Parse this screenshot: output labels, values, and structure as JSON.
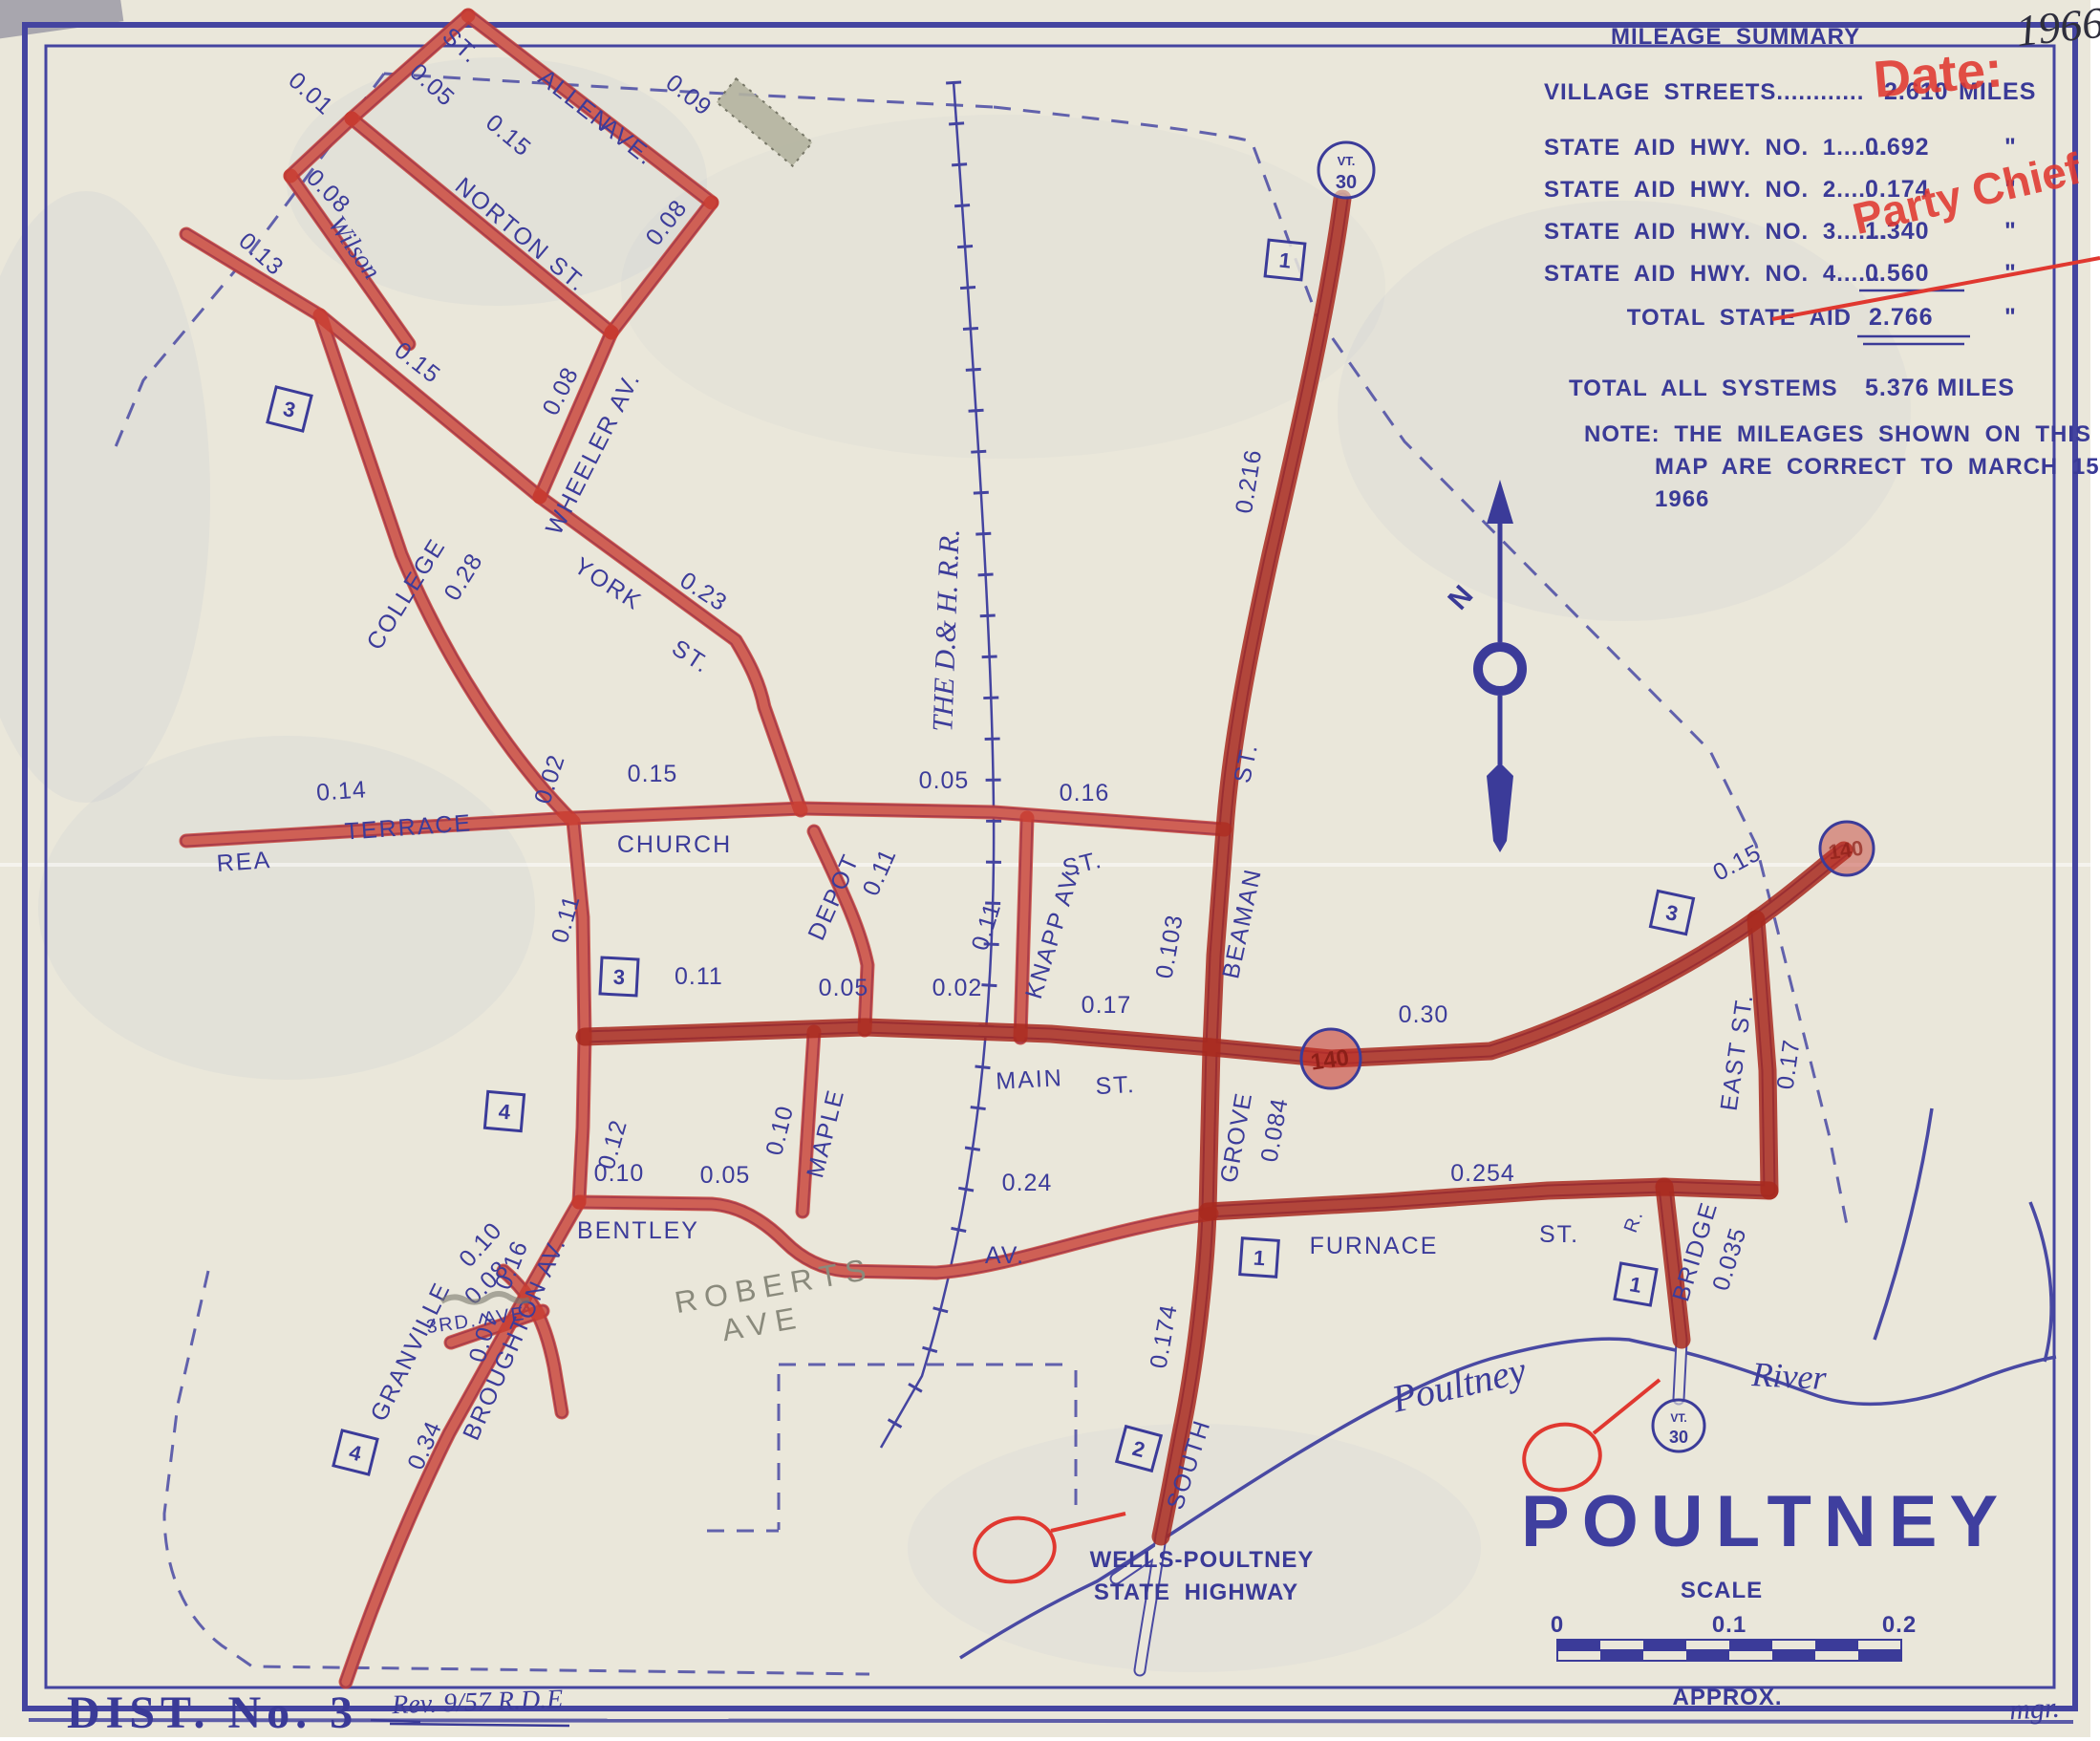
{
  "mileage_summary": {
    "title": "MILEAGE SUMMARY",
    "year_note": "1966",
    "rows": {
      "village": {
        "label": "VILLAGE STREETS",
        "dots": "............",
        "value": "2.610",
        "unit": "MILES"
      },
      "sa1": {
        "label": "STATE AID HWY. NO. 1",
        "dots": ".......",
        "value": "0.692",
        "unit": "\""
      },
      "sa2": {
        "label": "STATE AID HWY. NO. 2",
        "dots": ".....",
        "value": "0.174",
        "unit": "\""
      },
      "sa3": {
        "label": "STATE AID HWY. NO. 3",
        "dots": ".......",
        "value": "1.340",
        "unit": "\""
      },
      "sa4": {
        "label": "STATE AID HWY. NO. 4",
        "dots": "......",
        "value": "0.560",
        "unit": "\""
      },
      "total_state_aid": {
        "label": "TOTAL STATE AID",
        "value": "2.766",
        "unit": "\""
      },
      "total_all": {
        "label": "TOTAL ALL SYSTEMS",
        "value": "5.376 MILES"
      }
    },
    "note": {
      "l1": "NOTE: THE MILEAGES SHOWN ON THIS",
      "l2": "MAP ARE CORRECT TO MARCH 15,",
      "l3": "1966"
    }
  },
  "stamps": {
    "date": "Date:",
    "party_chief": "Party Chief"
  },
  "streets": {
    "allen": "ALLEN",
    "ave": "AVE.",
    "st": "ST.",
    "norton": "NORTON ST.",
    "wilson": "Wilson",
    "wheeler": "WHEELER AV.",
    "york": "YORK",
    "college": "COLLEGE",
    "rea": "REA",
    "terrace": "TERRACE",
    "church": "CHURCH",
    "depot": "DEPOT",
    "knapp": "KNAPP AV.",
    "main": "MAIN",
    "beaman": "BEAMAN",
    "grove": "GROVE",
    "south": "SOUTH",
    "furnace": "FURNACE",
    "east": "EAST ST.",
    "bridge": "BRIDGE",
    "r_abbr": "R.",
    "bentley": "BENTLEY",
    "av": "AV.",
    "maple": "MAPLE",
    "granville": "GRANVILLE",
    "broughton": "BROUGHTON AV.",
    "third": "3RD. AVE",
    "roberts_l1": "ROBERTS",
    "roberts_l2": "AVE",
    "railroad": "THE D.& H. R.R.",
    "river_l1": "Poultney",
    "river_l2": "River",
    "wells_l1": "WELLS-POULTNEY",
    "wells_l2": "STATE HIGHWAY"
  },
  "miles": {
    "m001": "0.01",
    "m002": "0.02",
    "m005": "0.05",
    "m007": "0.07",
    "m008": "0.08",
    "m009": "0.09",
    "m010": "0.10",
    "m011": "0.11",
    "m012": "0.12",
    "m013": "0.13",
    "m014": "0.14",
    "m015": "0.15",
    "m016": "0.16",
    "m017": "0.17",
    "m023": "0.23",
    "m024": "0.24",
    "m028": "0.28",
    "m030": "0.30",
    "m034": "0.34",
    "m035": "0.035",
    "m084": "0.084",
    "m103": "0.103",
    "m174": "0.174",
    "m216": "0.216",
    "m254": "0.254"
  },
  "markers": {
    "n1": "1",
    "n2": "2",
    "n3": "3",
    "n4": "4",
    "vt": "VT.",
    "r30": "30",
    "r140": "140"
  },
  "legend": {
    "town": "POULTNEY",
    "scale": "SCALE",
    "approx": "APPROX.",
    "s0": "0",
    "s1": "0.1",
    "s2": "0.2",
    "mgr": "mgr."
  },
  "footer": {
    "dist": "DIST. No. 3",
    "rev": "Rev. 9/57 R.D.E"
  },
  "compass": {
    "n": "N"
  }
}
